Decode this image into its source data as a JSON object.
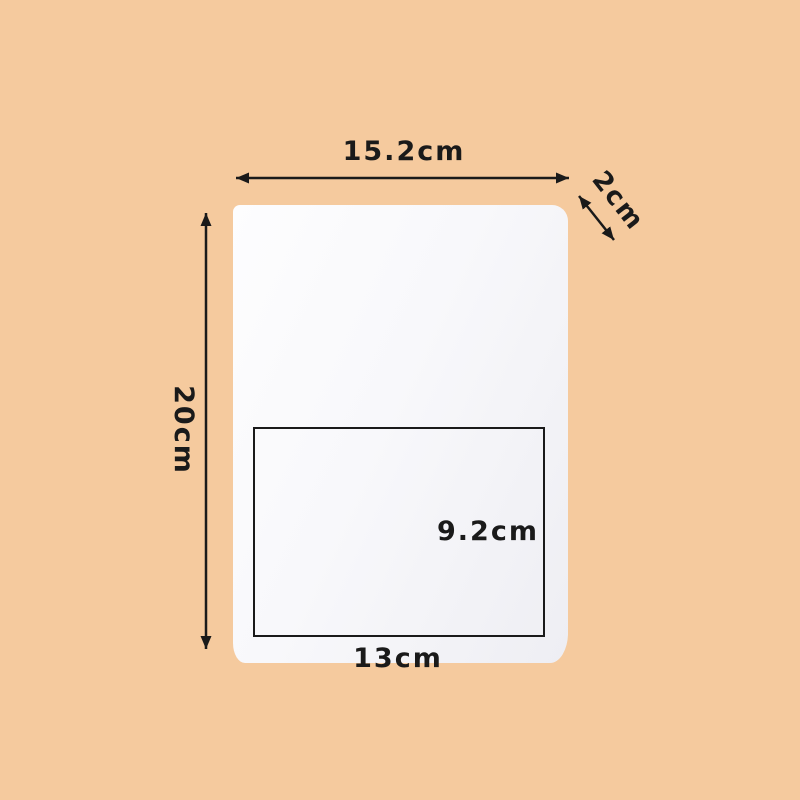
{
  "figure": {
    "background_color": "#f5ca9e",
    "ink_color": "#1a1a1a",
    "paper_color": "#fafafc",
    "labels": {
      "width": "15.2cm",
      "thickness": "2cm",
      "height": "20cm",
      "inner_height": "9.2cm",
      "inner_width": "13cm"
    }
  }
}
